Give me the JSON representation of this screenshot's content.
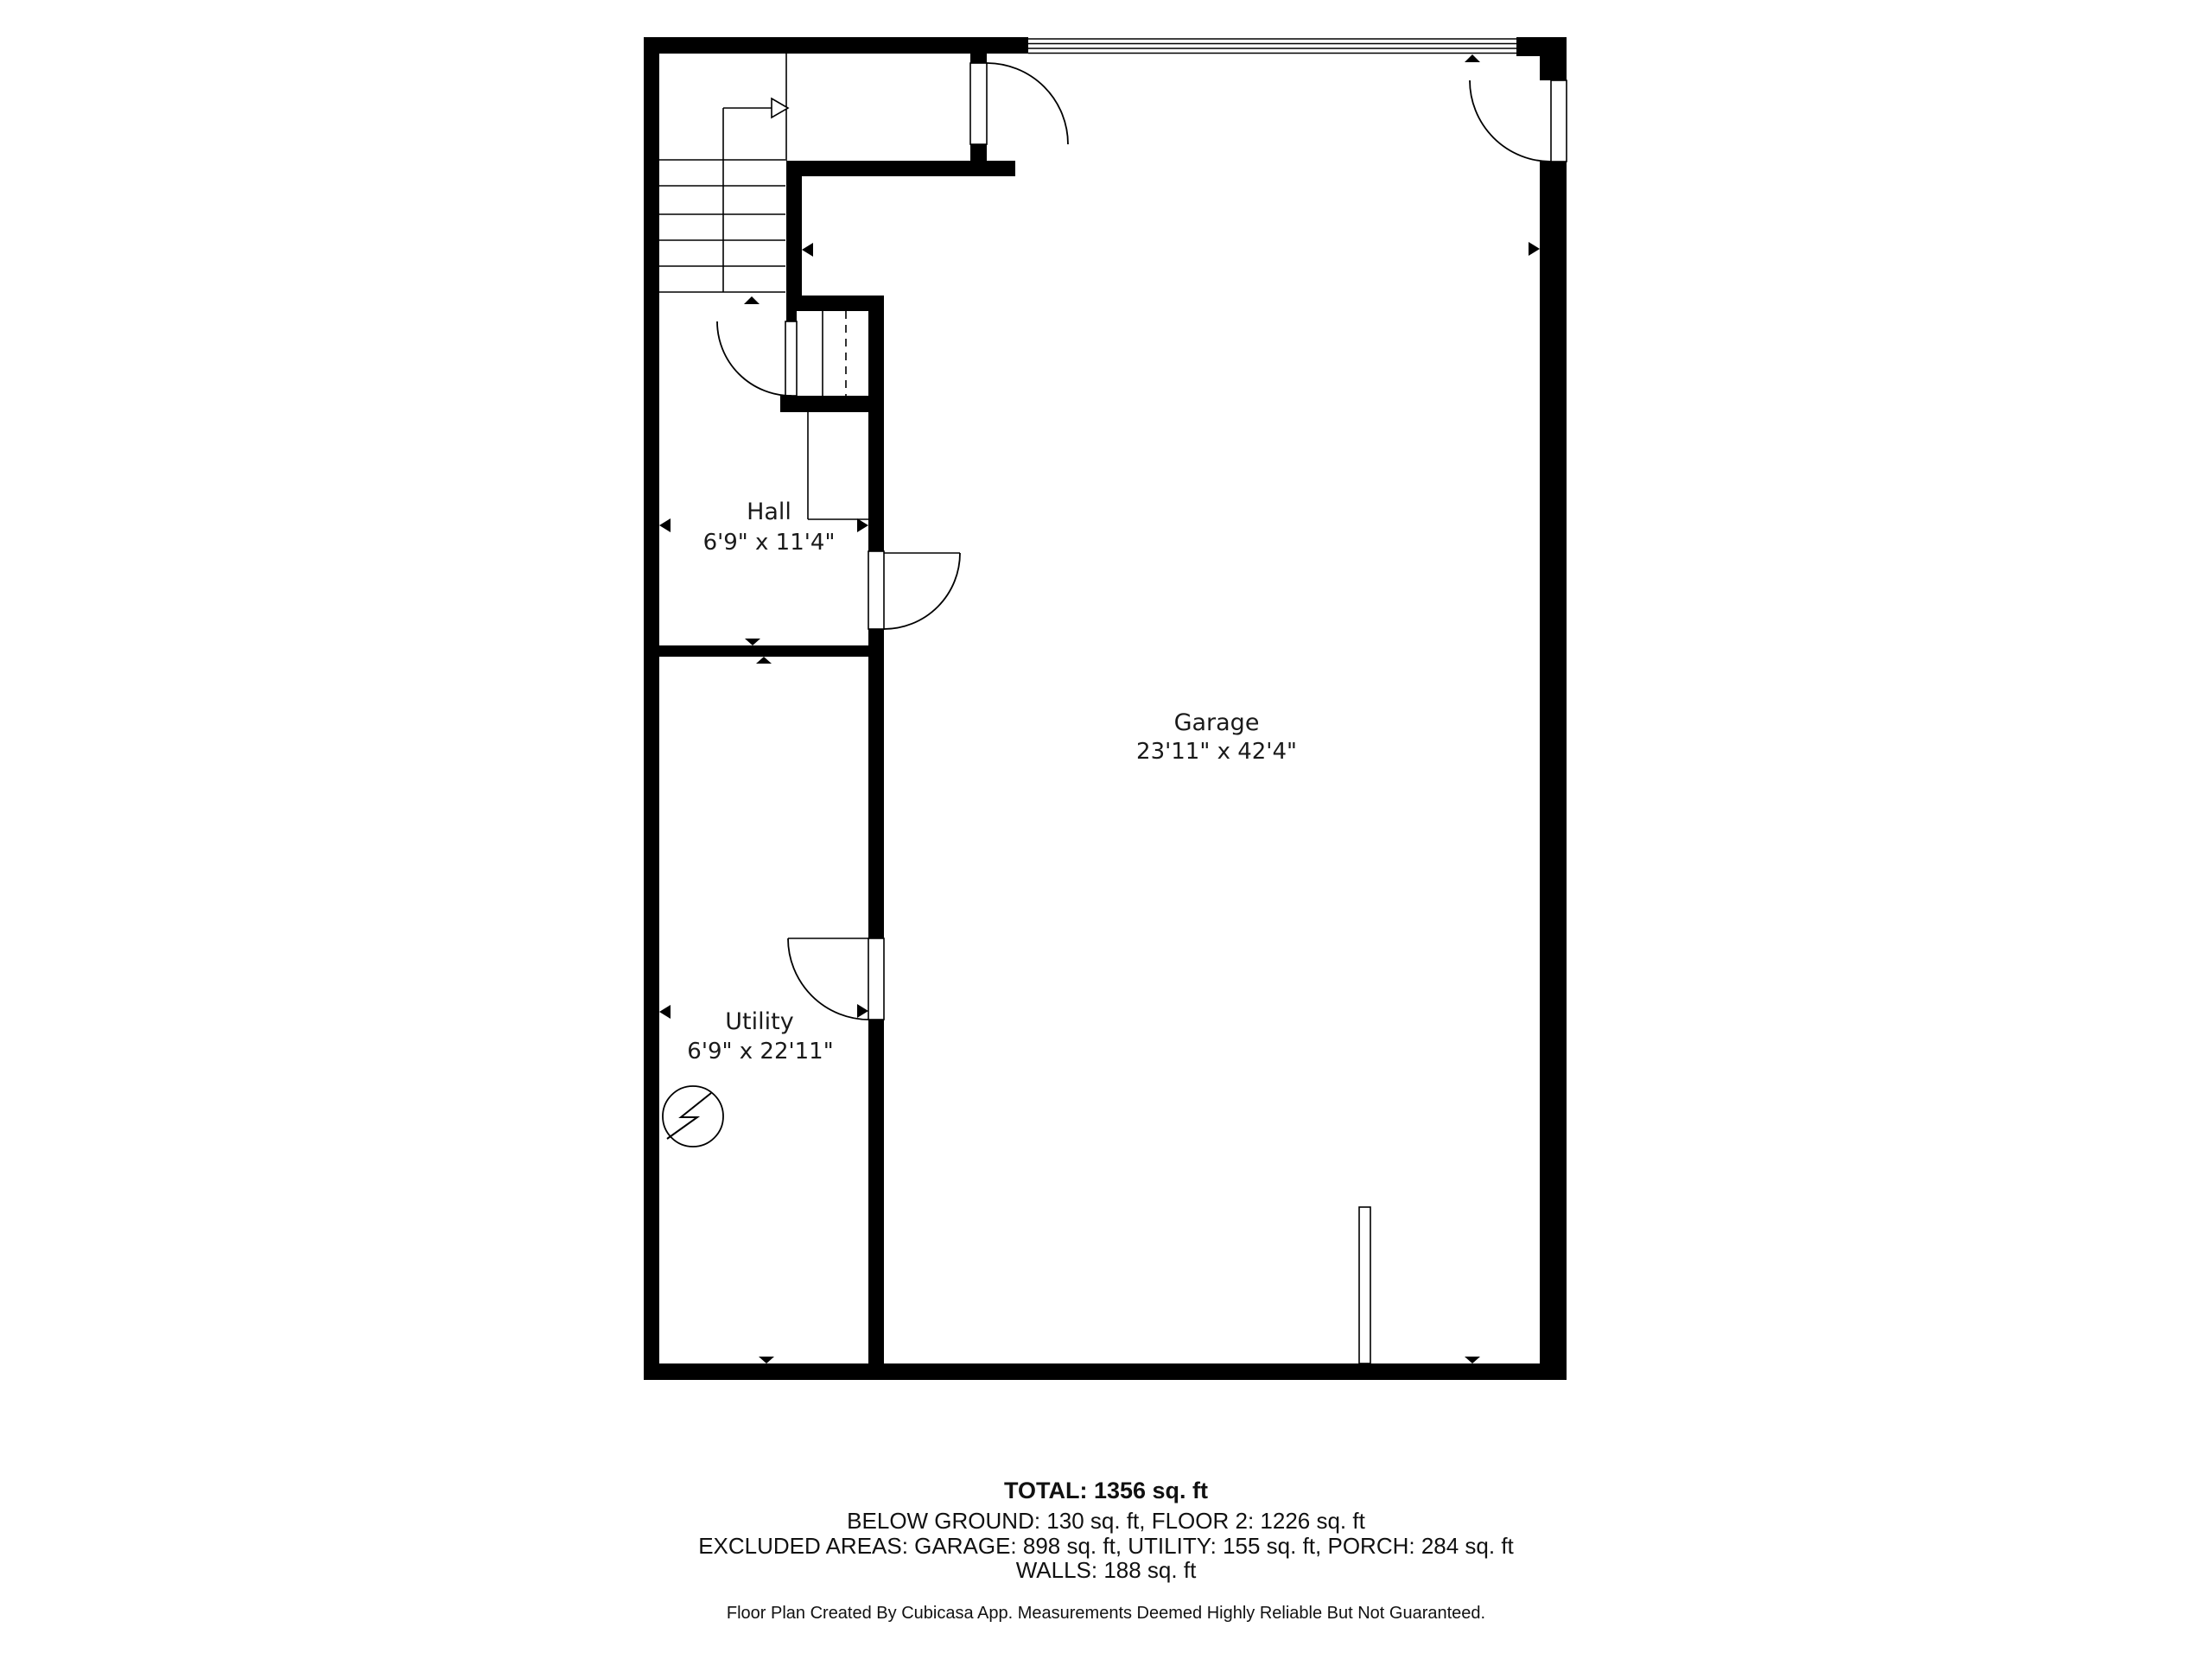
{
  "floor_plan": {
    "rooms": [
      {
        "name": "Hall",
        "dimensions": "6'9\" x 11'4\""
      },
      {
        "name": "Garage",
        "dimensions": "23'11\" x 42'4\""
      },
      {
        "name": "Utility",
        "dimensions": "6'9\" x 22'11\""
      }
    ],
    "summary": {
      "total": "TOTAL: 1356 sq. ft",
      "floors": "BELOW GROUND: 130 sq. ft, FLOOR 2: 1226 sq. ft",
      "excluded_areas": "EXCLUDED AREAS: GARAGE: 898 sq. ft, UTILITY: 155 sq. ft, PORCH: 284 sq. ft",
      "walls": "WALLS: 188 sq. ft"
    },
    "disclaimer": "Floor Plan Created By Cubicasa App. Measurements Deemed Highly Reliable But Not Guaranteed.",
    "colors": {
      "wall": "#000000",
      "background": "#ffffff",
      "text": "#1a1a1a"
    },
    "icons": {
      "electrical": "electrical-symbol",
      "stair_direction": "stair-up-arrow"
    }
  }
}
